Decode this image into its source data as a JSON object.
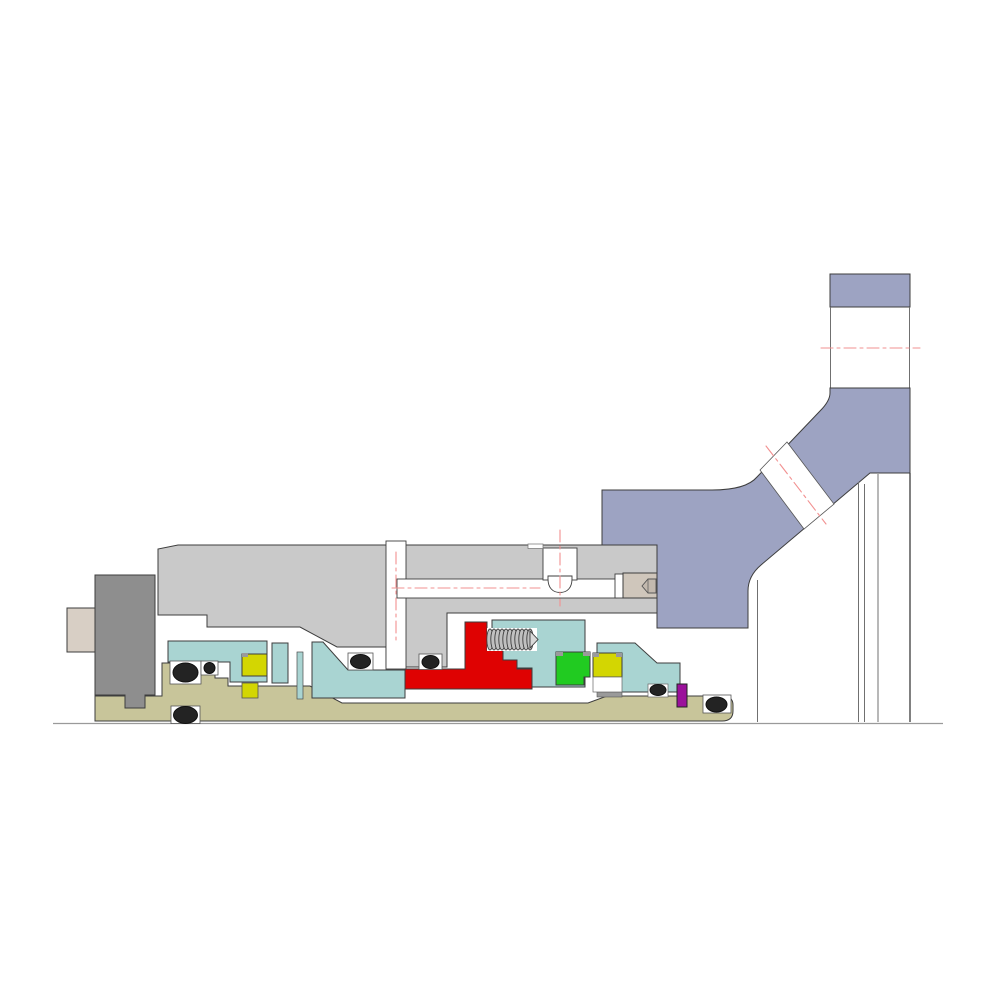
{
  "title": "Mechanical seal assembly cross-section drawing",
  "canvas": {
    "width": 1000,
    "height": 1000,
    "background": "#ffffff"
  },
  "colors": {
    "white": "#ffffff",
    "casing_blue": "#9da3c2",
    "gland_gray": "#c9c9c9",
    "collar_gray": "#8e8e8e",
    "shaft_beige": "#d8cfc5",
    "sleeve_olive": "#c8c59a",
    "retainer_teal": "#a9d4d2",
    "spring_holder_red": "#df0202",
    "seal_face_green": "#21cb21",
    "seal_face_yellow": "#d3d602",
    "pin_purple": "#9b119b",
    "oring_black": "#232323",
    "centerline_red": "#f29191",
    "spring_gray": "#c0c0c0",
    "plug_beige": "#cfc6bb",
    "plug_hex_beige": "#c3b9ae",
    "corner_tab_gray": "#9a9a9a",
    "strip_gray": "#9a9a9a"
  },
  "parts": {
    "pump_casing": {
      "label": "Pump casing with angled nozzle",
      "color_key": "casing_blue"
    },
    "nozzle_flange": {
      "label": "Vertical nozzle flange",
      "color_key": "casing_blue"
    },
    "gland_plate": {
      "label": "Seal gland plate",
      "color_key": "gland_gray"
    },
    "drive_collar": {
      "label": "Drive collar",
      "color_key": "collar_gray"
    },
    "shaft_end": {
      "label": "Shaft end",
      "color_key": "shaft_beige"
    },
    "shaft_sleeve": {
      "label": "Shaft sleeve",
      "color_key": "sleeve_olive"
    },
    "retainers": {
      "label": "Seal retainers / sleeves (4 pieces)",
      "color_key": "retainer_teal"
    },
    "spring_holder": {
      "label": "Spring holder / compression unit",
      "color_key": "spring_holder_red"
    },
    "spring": {
      "label": "Coil spring",
      "coil_count": 11,
      "color_key": "spring_gray"
    },
    "seal_face_green": {
      "label": "Primary seal face",
      "color_key": "seal_face_green"
    },
    "seal_faces_yellow": {
      "label": "Mating seal faces (2)",
      "color_key": "seal_face_yellow"
    },
    "orings": {
      "label": "Elastomer O-rings",
      "count": 7,
      "color_key": "oring_black"
    },
    "pin": {
      "label": "Anti-rotation pin",
      "color_key": "pin_purple"
    },
    "flush_port": {
      "label": "Flush port with dome bore",
      "color_key": "white"
    },
    "flush_plug": {
      "label": "Flush port plug with hex socket",
      "color_key": "plug_beige"
    },
    "centerlines": {
      "label": "Red dash-dot centerlines",
      "count": 6,
      "color_key": "centerline_red"
    },
    "baseline": {
      "label": "Shaft axis base line",
      "color_key": "strip_gray"
    }
  }
}
